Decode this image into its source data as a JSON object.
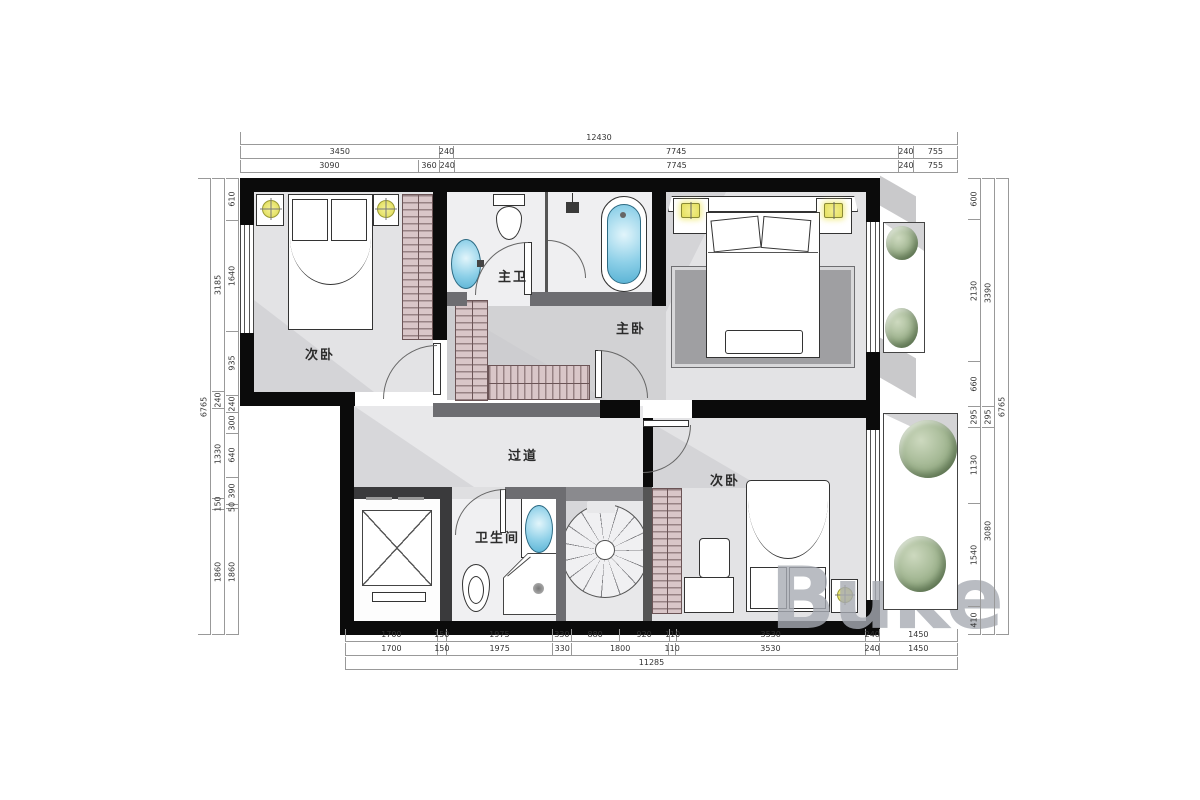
{
  "watermark": "Buke",
  "rooms": {
    "bedroom_top_left": "次卧",
    "master_bathroom": "主卫",
    "master_bedroom": "主卧",
    "hallway": "过道",
    "bathroom": "卫生间",
    "bedroom_bottom_right": "次卧"
  },
  "dimensions": {
    "top": {
      "row_total": [
        12430
      ],
      "row_mid": [
        3450,
        240,
        7745,
        240,
        755
      ],
      "row_inner": [
        3090,
        360,
        240,
        7745,
        240,
        755
      ]
    },
    "bottom": {
      "row_inner": [
        1700,
        150,
        1975,
        330,
        880,
        920,
        110,
        3530,
        240,
        1450
      ],
      "row_mid": [
        1700,
        150,
        1975,
        330,
        1800,
        110,
        3530,
        240,
        1450
      ],
      "row_total": [
        11285
      ]
    },
    "left": {
      "col_total": [
        6765
      ],
      "col_mid": [
        3185,
        240,
        1330,
        150,
        1860
      ],
      "col_inner": [
        610,
        1640,
        935,
        240,
        300,
        640,
        390,
        50,
        1860
      ]
    },
    "right": {
      "col_inner": [
        600,
        2130,
        660,
        295,
        1130,
        1540,
        410
      ],
      "col_mid": [
        3390,
        295,
        3080
      ],
      "col_total": [
        6765
      ]
    }
  },
  "colors": {
    "wall": "#0b0b0b",
    "floor": "#e3e3e5",
    "wardrobe": "#d9c6c8",
    "water": "#8ed0e8",
    "lamp": "#ece96d",
    "plant": "#9fb48f"
  }
}
